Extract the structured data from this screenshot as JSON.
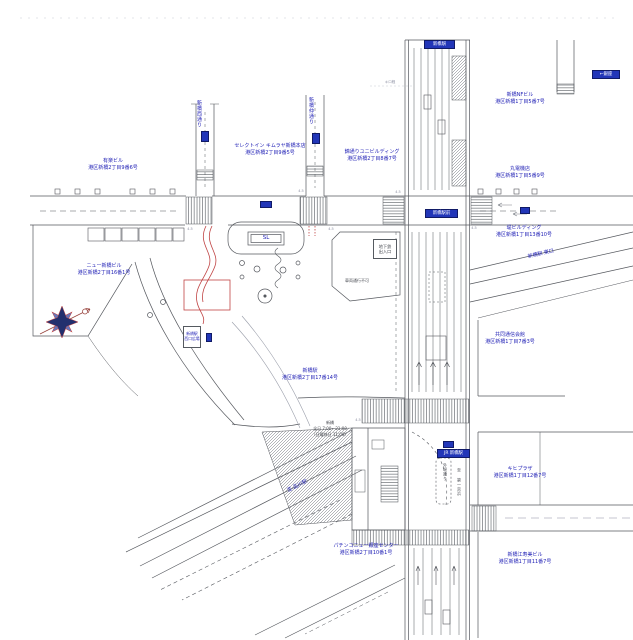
{
  "map": {
    "area_name": "新橋駅周辺",
    "accent_blue": "#1c1cb4",
    "sign_blue": "#2236b8",
    "accent_red": "#c04444",
    "line_gray": "#55585e"
  },
  "labels": {
    "yuraku": {
      "text": "有楽ビル\n港区新橋2丁目9番6号"
    },
    "select_inn": {
      "text": "セレクトイン キムラヤ新橋本店\n港区新橋2丁目9番5号"
    },
    "nishiki_bldg": {
      "text": "錦通りユニビルディング\n港区新橋2丁目8番7号"
    },
    "nf_bldg": {
      "text": "新橋NFビル\n港区新橋1丁目5番7号"
    },
    "denki": {
      "text": "丸電機店\n港区新橋1丁目5番9号"
    },
    "tsutsumi_bldg": {
      "text": "堤ビルディング\n港区新橋1丁目13番10号"
    },
    "kyodo": {
      "text": "共同通信会館\n港区新橋1丁目7番3号"
    },
    "new_shinbashi": {
      "text": "ニュー新橋ビル\n港区新橋2丁目16番1号"
    },
    "station": {
      "text": "新橋駅\n港区新橋2丁目17番14号"
    },
    "pachinko": {
      "text": "パチンコニュー銀座センター\n港区新橋2丁目10番1号"
    },
    "kihi_plaza": {
      "text": "キヒプラザ\n港区新橋1丁目12番7号"
    },
    "ezumi_bldg": {
      "text": "新橋江寿美ビル\n港区新橋1丁目11番7号"
    },
    "street_nishi": {
      "text": "新橋西通り"
    },
    "street_naka": {
      "text": "新橋仲通り"
    },
    "street_sotobori": {
      "text": "外堀通り"
    },
    "street_daiichi": {
      "text": "至 第一京浜"
    },
    "east_exit": {
      "text": "新橋駅 東口"
    },
    "to_shinagawa": {
      "text": "至 品川駅"
    },
    "vehicle_ban": {
      "text": "車両通行不可"
    },
    "subway_box": {
      "text": "地下鉄\n出入口"
    },
    "west_plaza_box": {
      "text": "新橋駅\n西口広場"
    },
    "sl": {
      "text": "SL"
    },
    "hours": {
      "text": "新橋\n全日 7:00～21:00\n（日曜休日 11:00）"
    },
    "kilo": {
      "text": "キロ程"
    }
  },
  "badges": {
    "north_gate": "新橋駅",
    "ginza": "←銀座",
    "ekimae": "新橋駅前",
    "jr": "JR 新橋駅"
  },
  "ticks": {
    "t1": "4.5",
    "t2": "4.5",
    "t3": "4.5",
    "t4": "4.5",
    "t5": "4.5",
    "t6": "4.5"
  }
}
